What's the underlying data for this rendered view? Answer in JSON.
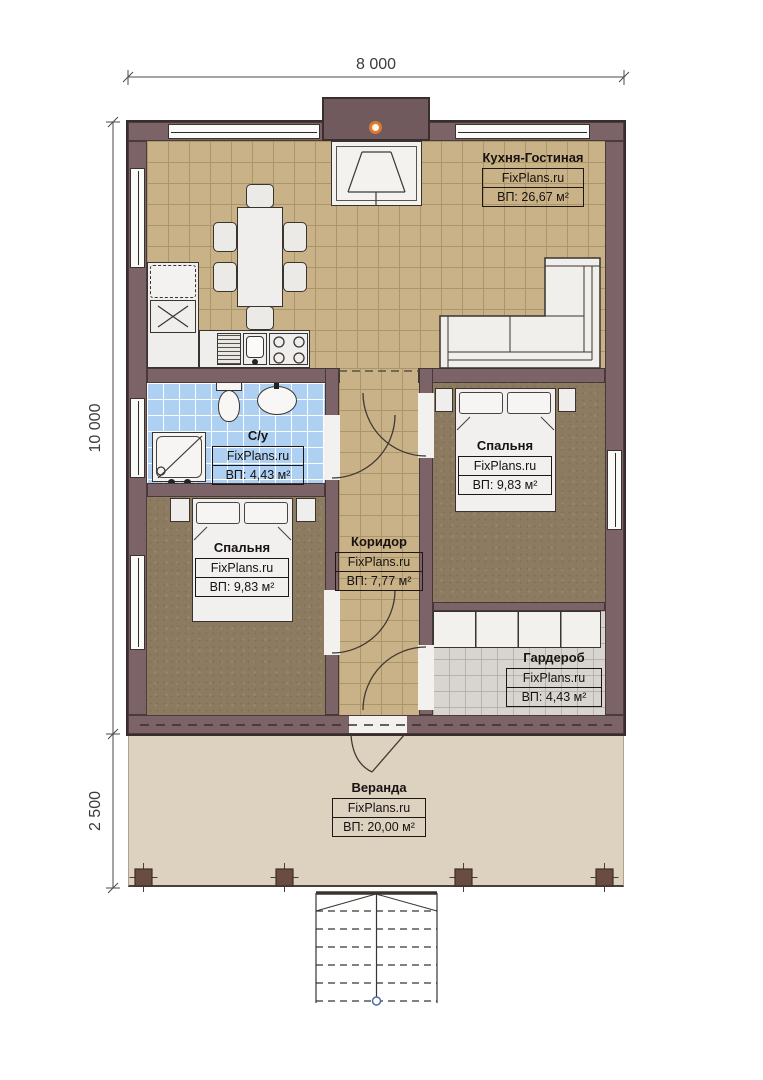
{
  "dimensions": {
    "width_top": "8 000",
    "height_main": "10 000",
    "height_veranda": "2 500"
  },
  "rooms": {
    "kitchen_living": {
      "name": "Кухня-Гостиная",
      "brand": "FixPlans.ru",
      "area": "ВП: 26,67 м²"
    },
    "bathroom": {
      "name": "С/у",
      "brand": "FixPlans.ru",
      "area": "ВП: 4,43 м²"
    },
    "bedroom_right": {
      "name": "Спальня",
      "brand": "FixPlans.ru",
      "area": "ВП: 9,83 м²"
    },
    "bedroom_left": {
      "name": "Спальня",
      "brand": "FixPlans.ru",
      "area": "ВП: 9,83 м²"
    },
    "corridor": {
      "name": "Коридор",
      "brand": "FixPlans.ru",
      "area": "ВП: 7,77 м²"
    },
    "wardrobe": {
      "name": "Гардероб",
      "brand": "FixPlans.ru",
      "area": "ВП: 4,43 м²"
    },
    "veranda": {
      "name": "Веранда",
      "brand": "FixPlans.ru",
      "area": "ВП: 20,00 м²"
    }
  },
  "colors": {
    "wall": "#7b6367",
    "kitchen_floor": "#c9b287",
    "bathroom_floor": "#aed0f3",
    "bedroom_floor": "#8d7b61",
    "wardrobe_floor": "#d8d5d1",
    "veranda_floor": "#ddd1c0",
    "chimney_accent": "#dd7a30"
  }
}
